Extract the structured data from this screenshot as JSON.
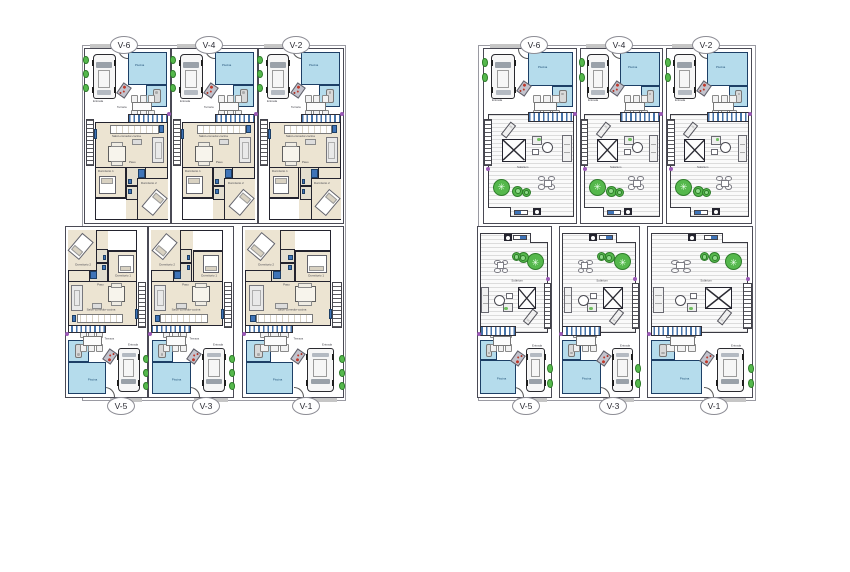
{
  "document": {
    "type": "architectural floor plan sheet",
    "background": "#ffffff"
  },
  "colors": {
    "pool_fill": "#b5dcec",
    "pool_border": "#1d3f66",
    "floor_beige": "#ece4d2",
    "wall_dark": "#23232e",
    "deck_line": "#dcdcdc",
    "pergola_blue": "#4472a8",
    "plant_green": "#55b84c",
    "accent_purple": "#9b59b6",
    "accent_red": "#c0392b",
    "pavement_gray": "#c6c6c6"
  },
  "blocks": [
    {
      "id": "ground-floor",
      "units": [
        {
          "label": "V-6"
        },
        {
          "label": "V-4"
        },
        {
          "label": "V-2"
        },
        {
          "label": "V-5"
        },
        {
          "label": "V-3"
        },
        {
          "label": "V-1"
        }
      ]
    },
    {
      "id": "roof",
      "units": [
        {
          "label": "V-6"
        },
        {
          "label": "V-4"
        },
        {
          "label": "V-2"
        },
        {
          "label": "V-5"
        },
        {
          "label": "V-3"
        },
        {
          "label": "V-1"
        }
      ]
    }
  ],
  "unit_texts": {
    "pool": "Piscina",
    "entrance": "Entrada",
    "terrace": "Terraza",
    "solarium": "Solárium",
    "living": "Salón-comedor-cocina",
    "bedroom1": "Dormitorio 1",
    "bedroom2": "Dormitorio 2",
    "hall": "Paso"
  }
}
